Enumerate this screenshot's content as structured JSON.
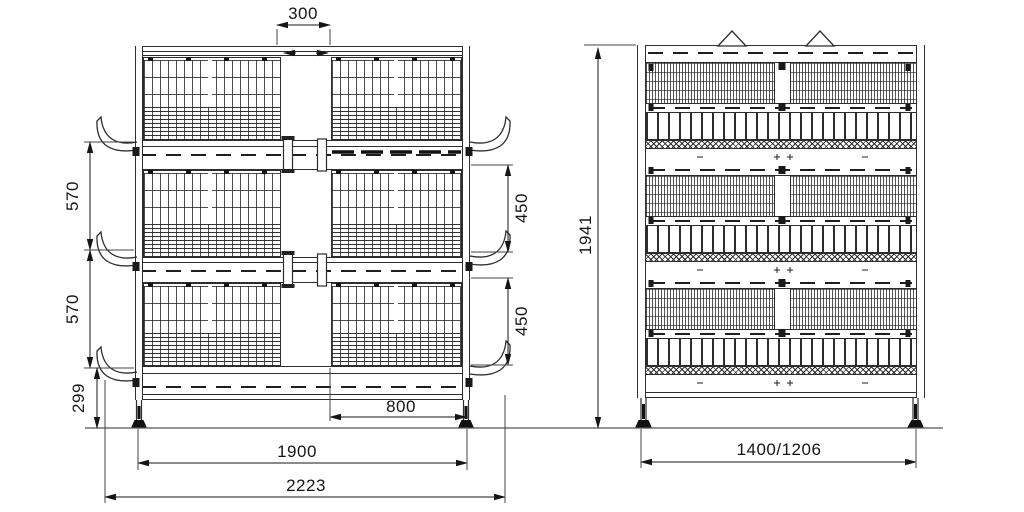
{
  "drawing": {
    "subject": "Three-tier poultry battery cage engineering drawing",
    "views": [
      {
        "id": "front",
        "name": "front elevation"
      },
      {
        "id": "side",
        "name": "side elevation"
      }
    ],
    "units": "mm",
    "colors": {
      "line": "#2d2d2d",
      "dimension": "#151515",
      "background": "#ffffff"
    }
  },
  "dims": {
    "top_gap": "300",
    "tier_pitch_upper": "570",
    "tier_pitch_lower": "570",
    "tier_height_mid": "450",
    "tier_height_low": "450",
    "leg_height": "299",
    "trough_offset": "800",
    "leg_span": "1900",
    "overall_width": "2223",
    "overall_height": "1941",
    "depth": "1400/1206"
  }
}
